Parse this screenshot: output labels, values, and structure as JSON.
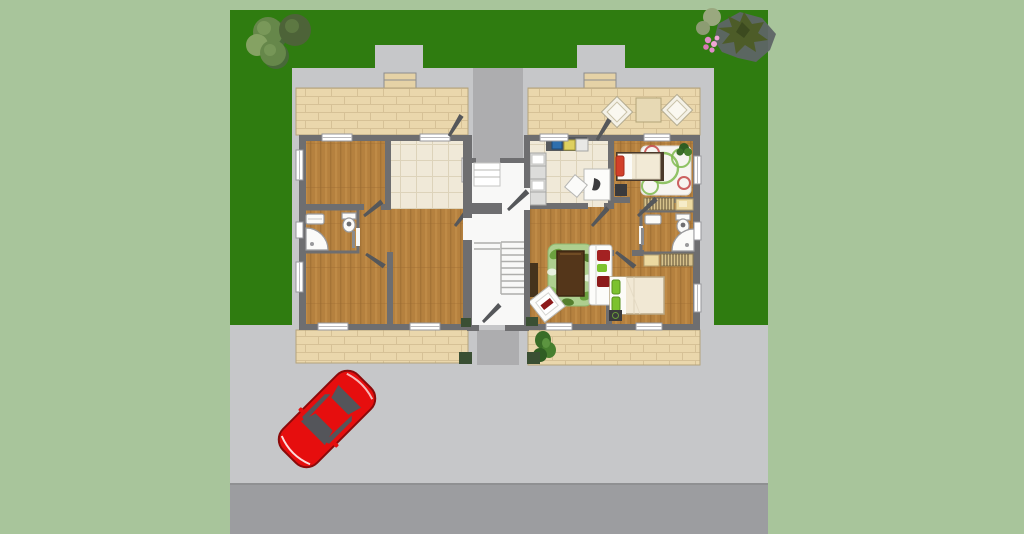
{
  "scene": {
    "type": "floor-plan-render",
    "description": "Top-down architectural rendering of a two-unit residence on a landscaped lot with lawn, paved courtyard, driveway, road and a parked red car",
    "left_unit": {
      "state": "unfurnished",
      "rooms": [
        "bedroom-top-left",
        "kitchen-top-right",
        "bathroom",
        "bedroom-bottom-left",
        "living-area"
      ],
      "fixtures": [
        "sink",
        "toilet",
        "corner-shower"
      ]
    },
    "right_unit": {
      "state": "furnished",
      "rooms": [
        "kitchen",
        "child-bedroom",
        "bathroom",
        "living-room",
        "bedroom"
      ],
      "furniture": [
        "kitchen-counter",
        "kitchen-table",
        "dining-chairs",
        "single-bed",
        "circle-rug",
        "potted-plant",
        "wardrobes",
        "sofa",
        "leaf-rug",
        "coffee-table",
        "lounge-chair",
        "sideboard",
        "double-bed",
        "nightstand"
      ]
    },
    "shared": [
      "stair-hall",
      "staircase",
      "entry-steps",
      "entry-walkways",
      "door-planters"
    ],
    "yard": [
      "lawn",
      "shrub-cluster",
      "conifer-tree",
      "light-bushes",
      "pink-flowers",
      "patio-terraces",
      "patio-chairs",
      "patio-table",
      "terrace-plants"
    ],
    "vehicle": {
      "kind": "red-car",
      "heading_deg": 225
    }
  },
  "colors": {
    "page_bg": "#a8c59b",
    "grass": "#2f7c10",
    "pavement": "#c6c7c9",
    "path": "#adadaf",
    "road": "#9c9da0",
    "road_line": "#8f9092",
    "wall": "#6e6e70",
    "patio": "#ead7ac",
    "patio_line": "#d2bd92",
    "step": "#e5d2a6",
    "wood": "#b5813f",
    "wood_dark": "#9c6c32",
    "wood_light": "#c9954f",
    "tile_cream": "#f0e9d8",
    "tile_line": "#ddd3ba",
    "bath": "#f7f7f5",
    "bath_line": "#e2e2de",
    "dark_furn": "#3a3a3c",
    "table_brown": "#54361a",
    "rug_green": "#aecf8f",
    "leaf": "#6ca13f",
    "sofa_red": "#a32222",
    "pillow_green": "#7cc22e",
    "pillow_red": "#d2402a",
    "planter": "#3a4f33",
    "bush": "#66874a",
    "bush_dark": "#4d6338",
    "bush_light": "#85a263",
    "conifer": "#4d5c28",
    "conifer_shadow": "#5e6566",
    "flower_pink": "#e08cc8",
    "car_red": "#e60e0e",
    "car_dark": "#54555a"
  }
}
